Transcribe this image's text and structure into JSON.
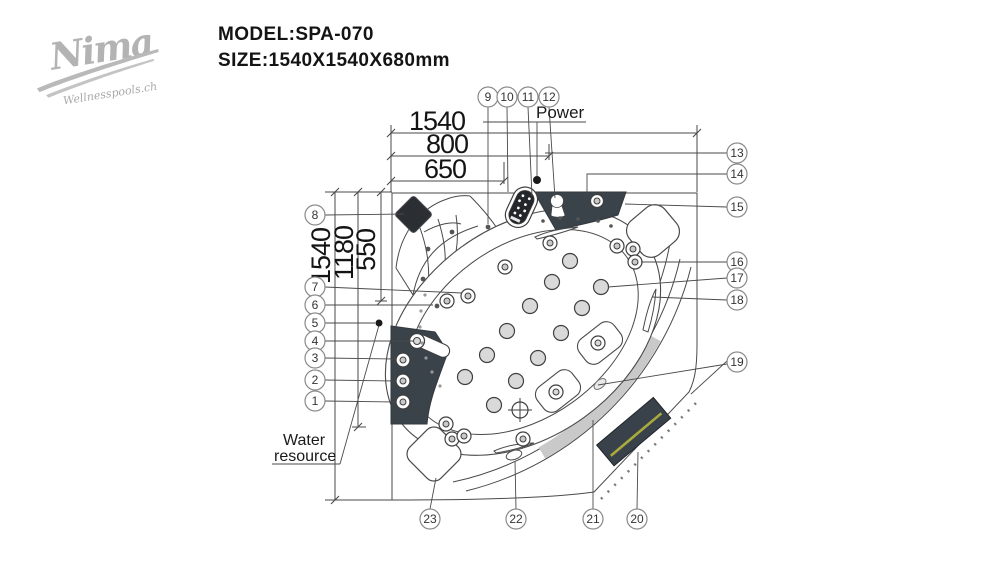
{
  "logo": {
    "brand": "Nima",
    "tagline": "Wellnesspools.ch"
  },
  "header": {
    "model": "MODEL:SPA-070",
    "size": "SIZE:1540X1540X680mm"
  },
  "labels": {
    "power": "Power",
    "water_line1": "Water",
    "water_line2": "resource"
  },
  "dimensions": {
    "top": {
      "d1": "1540",
      "d2": "800",
      "d3": "650"
    },
    "left": {
      "d1": "1540",
      "d2": "1180",
      "d3": "550"
    }
  },
  "callouts": {
    "c1": "1",
    "c2": "2",
    "c3": "3",
    "c4": "4",
    "c5": "5",
    "c6": "6",
    "c7": "7",
    "c8": "8",
    "c9": "9",
    "c10": "10",
    "c11": "11",
    "c12": "12",
    "c13": "13",
    "c14": "14",
    "c15": "15",
    "c16": "16",
    "c17": "17",
    "c18": "18",
    "c19": "19",
    "c20": "20",
    "c21": "21",
    "c22": "22",
    "c23": "23"
  },
  "colors": {
    "line": "#4a4a4a",
    "panel_dark": "#3a424a",
    "pillow_dark": "#2b2e33",
    "band_gray": "#c9c9c9",
    "stripe_yellow": "#a9aa3c",
    "logo_gray": "#b3b3b3"
  }
}
